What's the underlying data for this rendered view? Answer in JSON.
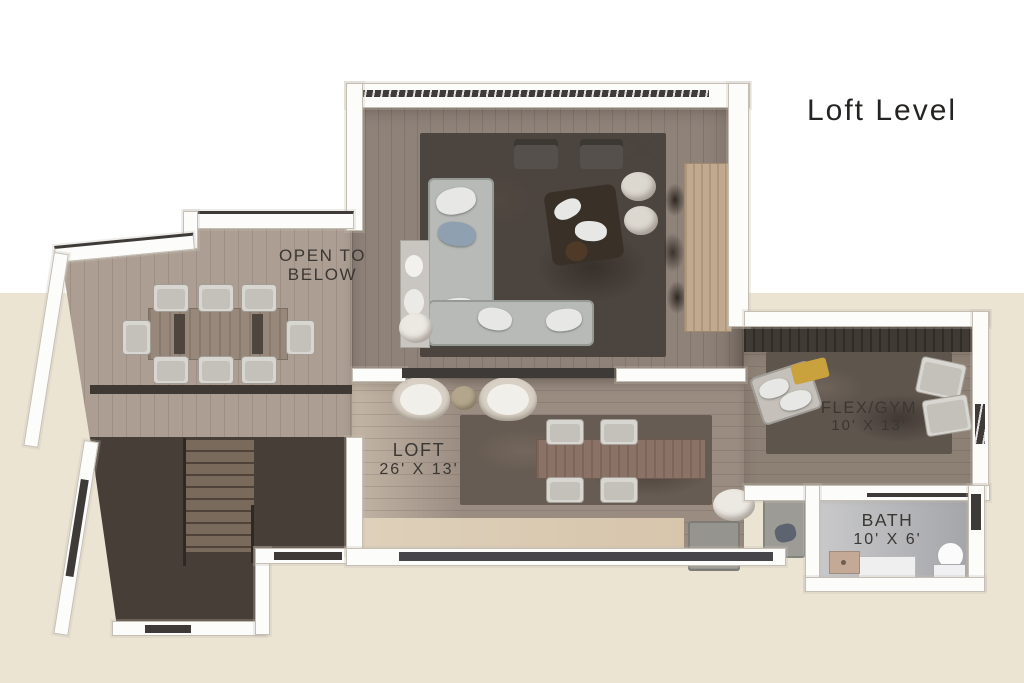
{
  "title": {
    "text": "Loft Level"
  },
  "labels": {
    "open_to_below": {
      "line1": "OPEN TO",
      "line2": "BELOW"
    },
    "loft": {
      "name": "LOFT",
      "dims": "26' X 13'"
    },
    "flex_gym": {
      "name": "FLEX/GYM",
      "dims": "10' X 13'"
    },
    "bath": {
      "name": "BATH",
      "dims": "10' X 6'"
    }
  },
  "colors": {
    "bg_top": "#ffffff",
    "bg_bottom": "#ece4d3",
    "title_text": "#262422",
    "label_text": "#3b3733",
    "wall_white": "#fcfcfb",
    "wall_dark": "#3e3a37",
    "floor_living": "#8e8279",
    "floor_dining": "#ac9e93",
    "floor_loft": "#9a8c81",
    "floor_flex": "#8d8075",
    "floor_stairs": "#473e37",
    "floor_bath_light": "#cccccd",
    "floor_bath_dark": "#a2a3a7",
    "rug_dark": "#4c443f",
    "cream_band": "#d7c5ac"
  },
  "furniture": [
    "sectional-sofa",
    "living-area-rug",
    "lounge-chairs",
    "decor-x-stool",
    "coffee-table-set",
    "round-poufs",
    "wood-console",
    "dining-table",
    "dining-chairs",
    "staircase",
    "barrel-chairs",
    "round-side-table",
    "loft-table",
    "loft-chairs",
    "gray-sofa",
    "gym-rug",
    "chaise-lounge",
    "accent-chairs",
    "toilet",
    "vanity-sink"
  ]
}
